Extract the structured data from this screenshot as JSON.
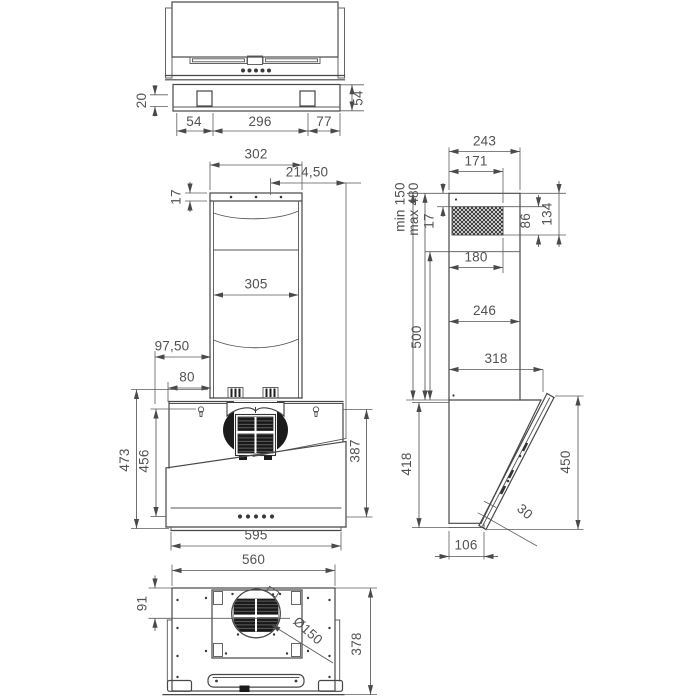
{
  "views": {
    "top": {
      "dims": {
        "bracket_height": "20",
        "plate_depth": "54",
        "spacing_left": "54",
        "spacing_center": "296",
        "spacing_right": "77"
      }
    },
    "front": {
      "dims": {
        "chimney_width": "302",
        "cap_height": "17",
        "outlet_offset": "214,50",
        "duct_width": "305",
        "offset_upper": "97,50",
        "offset_lower": "80",
        "height_overall": "473",
        "height_inner": "456",
        "glass_height": "387",
        "body_width": "595"
      }
    },
    "side": {
      "dims": {
        "depth_top": "243",
        "grille_width": "171",
        "ext_min": "min 150",
        "ext_max": "max 480",
        "grille_offset": "17",
        "grille_height": "86",
        "grille_span": "134",
        "bracket_width": "180",
        "chimney_height": "500",
        "depth_mid": "246",
        "depth_lower": "318",
        "body_height": "418",
        "glass_length": "450",
        "glass_gap": "30",
        "base_depth": "106"
      }
    },
    "bottom": {
      "dims": {
        "width": "560",
        "outlet_offset": "91",
        "outlet_diameter": "Ø150",
        "depth": "378"
      }
    }
  }
}
